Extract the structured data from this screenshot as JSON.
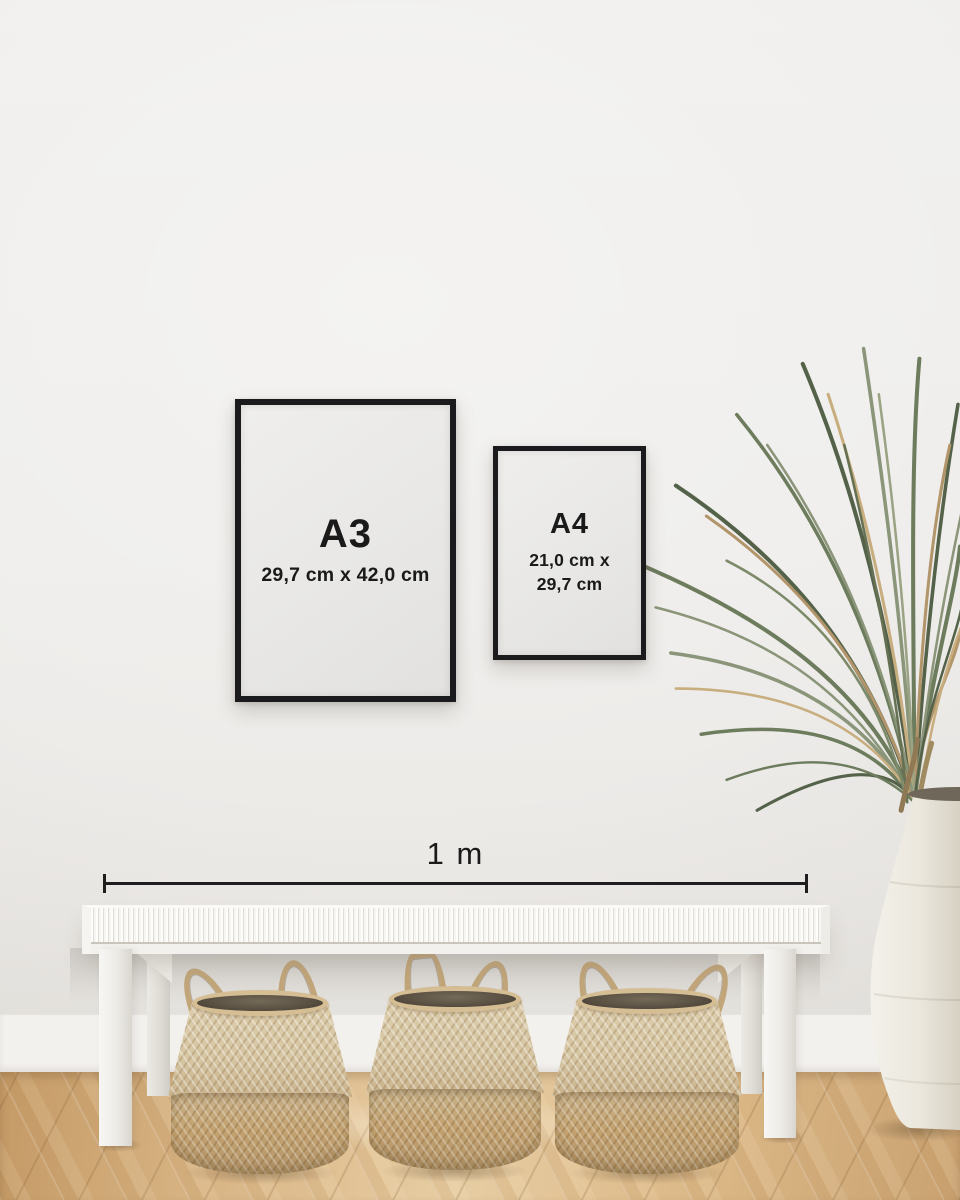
{
  "frames": {
    "a3": {
      "label": "A3",
      "dimensions": "29,7 cm x 42,0 cm"
    },
    "a4": {
      "label": "A4",
      "dimensions_line1": "21,0 cm x",
      "dimensions_line2": "29,7 cm"
    }
  },
  "measurement": {
    "label": "1 m"
  },
  "colors": {
    "wall": "#efeeec",
    "baseboard": "#f3f1ee",
    "floor_base": "#d4ae7e",
    "frame": "#1b1b1e",
    "paper": "#e9e8e6",
    "text": "#1a1a1a",
    "measure_line": "#1e1e1e",
    "bench": "#f4f2ee",
    "bench_shade": "#d9d6cf",
    "basket_light": "#d6c5a2",
    "basket_mid": "#c9b38c",
    "basket_dark": "#c3a270",
    "basket_interior": "#5b5244",
    "basket_rope": "#c2a67a",
    "plant_green_dark": "#55624a",
    "plant_green": "#6e7c5e",
    "plant_green_light": "#8a9579",
    "plant_brown": "#b2956a",
    "plant_tan": "#c8ad7e",
    "vase_light": "#f3f1ea",
    "vase_shade": "#d7d1c3"
  }
}
